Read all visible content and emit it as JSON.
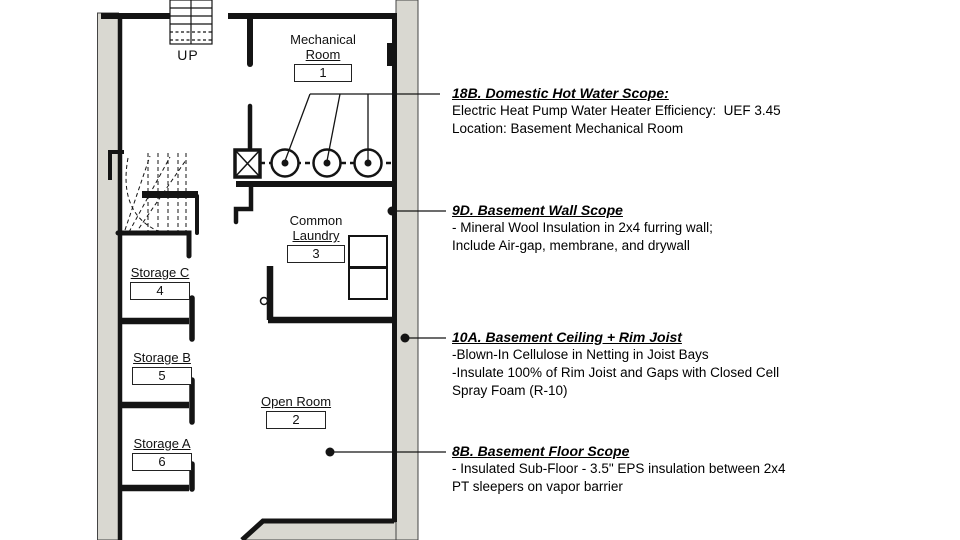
{
  "plan": {
    "stair_label": "UP",
    "rooms": [
      {
        "id": "mechanical-room",
        "line1": "Mechanical",
        "line2": "Room",
        "number": "1"
      },
      {
        "id": "common-laundry",
        "line1": "Common",
        "line2": "Laundry",
        "number": "3"
      },
      {
        "id": "storage-c",
        "line1": "",
        "line2": "Storage C",
        "number": "4"
      },
      {
        "id": "storage-b",
        "line1": "",
        "line2": "Storage B",
        "number": "5"
      },
      {
        "id": "storage-a",
        "line1": "",
        "line2": "Storage A",
        "number": "6"
      },
      {
        "id": "open-room",
        "line1": "",
        "line2": "Open Room",
        "number": "2"
      }
    ],
    "fixtures": [
      "water-heater",
      "water-heater",
      "water-heater",
      "equipment-box",
      "washer",
      "dryer",
      "winder-stair",
      "straight-stair"
    ]
  },
  "annotations": [
    {
      "id": "18B",
      "heading": "18B. Domestic Hot Water Scope:",
      "lines": [
        "Electric Heat Pump Water Heater Efficiency:  UEF 3.45",
        "Location: Basement Mechanical Room"
      ]
    },
    {
      "id": "9D",
      "heading": "9D. Basement Wall Scope",
      "lines": [
        "- Mineral Wool Insulation in 2x4 furring wall;",
        "Include Air-gap, membrane, and drywall"
      ]
    },
    {
      "id": "10A",
      "heading": "10A. Basement Ceiling + Rim Joist",
      "lines": [
        "-Blown-In Cellulose in Netting in Joist Bays",
        "-Insulate 100% of Rim Joist and Gaps with Closed Cell",
        "Spray Foam (R-10)"
      ]
    },
    {
      "id": "8B",
      "heading": "8B. Basement Floor Scope",
      "lines": [
        "- Insulated Sub-Floor - 3.5\" EPS insulation between 2x4",
        "PT sleepers on vapor barrier"
      ]
    }
  ],
  "colors": {
    "wall_fill": "#d9d8d1",
    "line": "#141414",
    "background": "#ffffff"
  }
}
